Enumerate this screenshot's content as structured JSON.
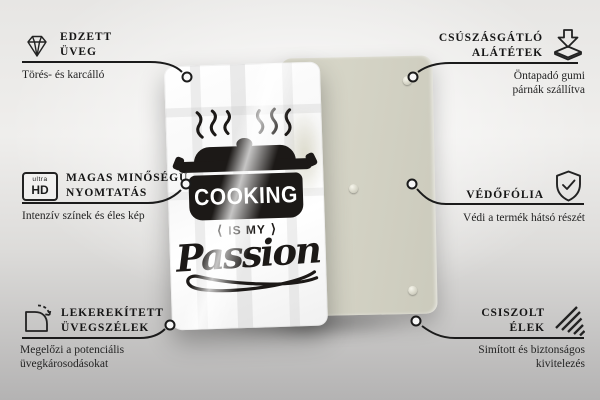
{
  "design": {
    "cooking": "COOKING",
    "is_my": "IS MY",
    "passion": "Passion",
    "decor_left": "⟨",
    "decor_right": "⟩"
  },
  "callouts": {
    "tempered_glass": {
      "line1": "EDZETT",
      "line2": "ÜVEG",
      "sub1": "Törés- és karcálló"
    },
    "hq_print": {
      "line1": "MAGAS MINŐSÉGŰ",
      "line2": "NYOMTATÁS",
      "sub1": "Intenzív színek és éles kép",
      "badge_small": "ultra",
      "badge_big": "HD"
    },
    "rounded_edges": {
      "line1": "LEKEREKÍTETT",
      "line2": "ÜVEGSZÉLEK",
      "sub1": "Megelőzi a potenciális",
      "sub2": "üvegkárosodásokat"
    },
    "antislip": {
      "line1": "CSÚSZÁSGÁTLÓ",
      "line2": "ALÁTÉTEK",
      "sub1": "Öntapadó gumi",
      "sub2": "párnák szállítva"
    },
    "protective_film": {
      "line1": "VÉDŐFÓLIA",
      "sub1": "Védi a termék hátsó részét"
    },
    "polished_edges": {
      "line1": "CSISZOLT",
      "line2": "ÉLEK",
      "sub1": "Simított és biztonságos",
      "sub2": "kivitelezés"
    }
  },
  "colors": {
    "connector_line": "#1b1b1b",
    "design_ink": "#1c1917",
    "back_panel": "#d5d4c6",
    "glass": "#ffffff"
  }
}
